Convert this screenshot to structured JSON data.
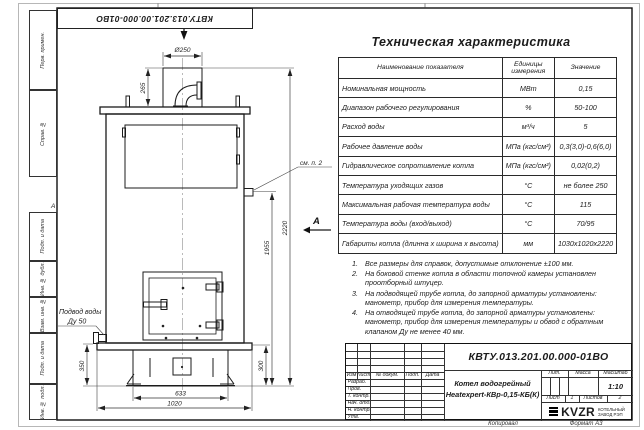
{
  "sheet": {
    "doc_number_top": "КВТУ.013.201.00.000-01ВО",
    "zone_label": "А",
    "margin_stamps": {
      "perv_primen": "Перв. примен.",
      "sprav_no": "Справ. №",
      "podp_data_1": "Подп. и дата",
      "inv_dubl": "Инв. № дубл.",
      "vzam_inv": "Взам. инв. №",
      "podp_data_2": "Подп. и дата",
      "inv_podl": "Инв. № подл."
    },
    "kopiroval": "Копировал",
    "format": "Формат А3"
  },
  "drawing": {
    "view_b": "Б",
    "view_a": "А",
    "dims": {
      "d250": "Ø250",
      "h265": "265",
      "h2220": "2220",
      "h1955": "1955",
      "h350": "350",
      "h300": "300",
      "w633": "633",
      "w1020": "1020"
    },
    "callouts": {
      "see_note": "см. п. 2",
      "inlet1": "Подвод воды",
      "inlet2": "Ду 50"
    }
  },
  "spec_table": {
    "title": "Техническая характеристика",
    "headers": {
      "name": "Наименование показателя",
      "units": "Единицы измерения",
      "value": "Значение"
    },
    "rows": [
      {
        "name": "Номинальная мощность",
        "units": "МВт",
        "value": "0,15"
      },
      {
        "name": "Диапазон рабочего регулирования",
        "units": "%",
        "value": "50-100"
      },
      {
        "name": "Расход воды",
        "units": "м³/ч",
        "value": "5"
      },
      {
        "name": "Рабочее давление воды",
        "units": "МПа (кгс/см²)",
        "value": "0,3(3,0)-0,6(6,0)"
      },
      {
        "name": "Гидравлическое сопротивление котла",
        "units": "МПа (кгс/см²)",
        "value": "0,02(0,2)"
      },
      {
        "name": "Температура уходящих газов",
        "units": "°С",
        "value": "не более 250"
      },
      {
        "name": "Максимальная рабочая температура воды",
        "units": "°С",
        "value": "115"
      },
      {
        "name": "Температура воды (вход/выход)",
        "units": "°С",
        "value": "70/95"
      },
      {
        "name": "Габариты котла (длинна x ширина x высота)",
        "units": "мм",
        "value": "1030x1020x2220"
      }
    ]
  },
  "notes": {
    "items": [
      {
        "num": "1.",
        "text": "Все размеры для справок, допустимые отклонение ±100 мм."
      },
      {
        "num": "2.",
        "text": "На боковой стенке котла в области топочной камеры установлен проотборный штуцер."
      },
      {
        "num": "3.",
        "text": "На подводящей трубе котла, до запорной арматуры установлены: манометр, прибор для измерения температуры."
      },
      {
        "num": "4.",
        "text": "На отводящей трубе котла, до запорной арматуры установлены: манометр, прибор для измерения температуры и обвод с обратным клапаном Ду не менее 40 мм."
      }
    ]
  },
  "title_block": {
    "doc_number": "КВТУ.013.201.00.000-01ВО",
    "name_line1": "Котел водогрейный",
    "name_line2": "Heatexpert-КВр-0,15-КБ(К)",
    "cols": {
      "izm": "Изм",
      "list": "Лист",
      "docum": "№ докум.",
      "podp": "Подп.",
      "data": "Дата"
    },
    "rows": {
      "razrab": "Разраб.",
      "prov": "Пров.",
      "tkontr": "Т. контр.",
      "nachotd": "Нач. отд.",
      "nkontr": "Н. контр.",
      "utv": "Утв."
    },
    "lit": "Лит.",
    "massa": "Масса",
    "masshtab": "Масштаб",
    "scale": "1:10",
    "list_label": "Лист",
    "list_num": "1",
    "listov_label": "Листов",
    "listov_num": "2",
    "logo": "KVZR",
    "company1": "КОТЕЛЬНЫЙ",
    "company2": "ЗАВОД РЭП"
  }
}
